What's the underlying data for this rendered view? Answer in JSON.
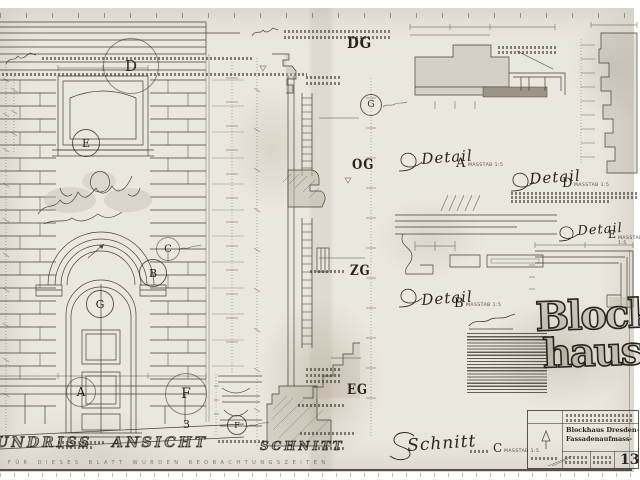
{
  "colors": {
    "paper": "#eae7df",
    "ink": "#2a251c",
    "shade": "#b9b2a3"
  },
  "drawing": {
    "floor_labels": {
      "dg": "DG",
      "og": "OG",
      "zg": "ZG",
      "eg": "EG"
    },
    "callouts": {
      "d": "D",
      "e": "E",
      "c": "C",
      "b": "B",
      "g_elevation": "G",
      "a": "A",
      "f_large": "F",
      "f_small": "F",
      "g_section": "G"
    },
    "course_number": "3",
    "captions": {
      "grundriss_partial": "UNDRISS",
      "ansicht": "ANSICHT",
      "schnitt": "SCHNITT"
    },
    "detail_labels": {
      "a": {
        "script": "Detail",
        "letter": "A",
        "scale": "MASSTAB 1:5"
      },
      "d": {
        "script": "Detail",
        "letter": "D",
        "scale": "MASSTAB 1:5"
      },
      "b": {
        "script": "Detail",
        "letter": "B",
        "scale": "MASSTAB 1:5"
      },
      "e": {
        "script": "Detail",
        "letter": "E",
        "scale": "MASSTAB 1:5"
      },
      "c_section": {
        "script": "Schnitt",
        "letter": "C",
        "scale": "MASSTAB 1:5"
      }
    },
    "branding": {
      "line1": "Block-",
      "line2": "haus"
    },
    "title_block": {
      "project_line1": "Blockhaus Dresden-",
      "project_line2": "Fassadenaufmass-",
      "sheet_number": "13"
    },
    "footer_note": "FÜR DIESES BLATT WURDEN BEOBACHTUNGSZEITEN"
  }
}
